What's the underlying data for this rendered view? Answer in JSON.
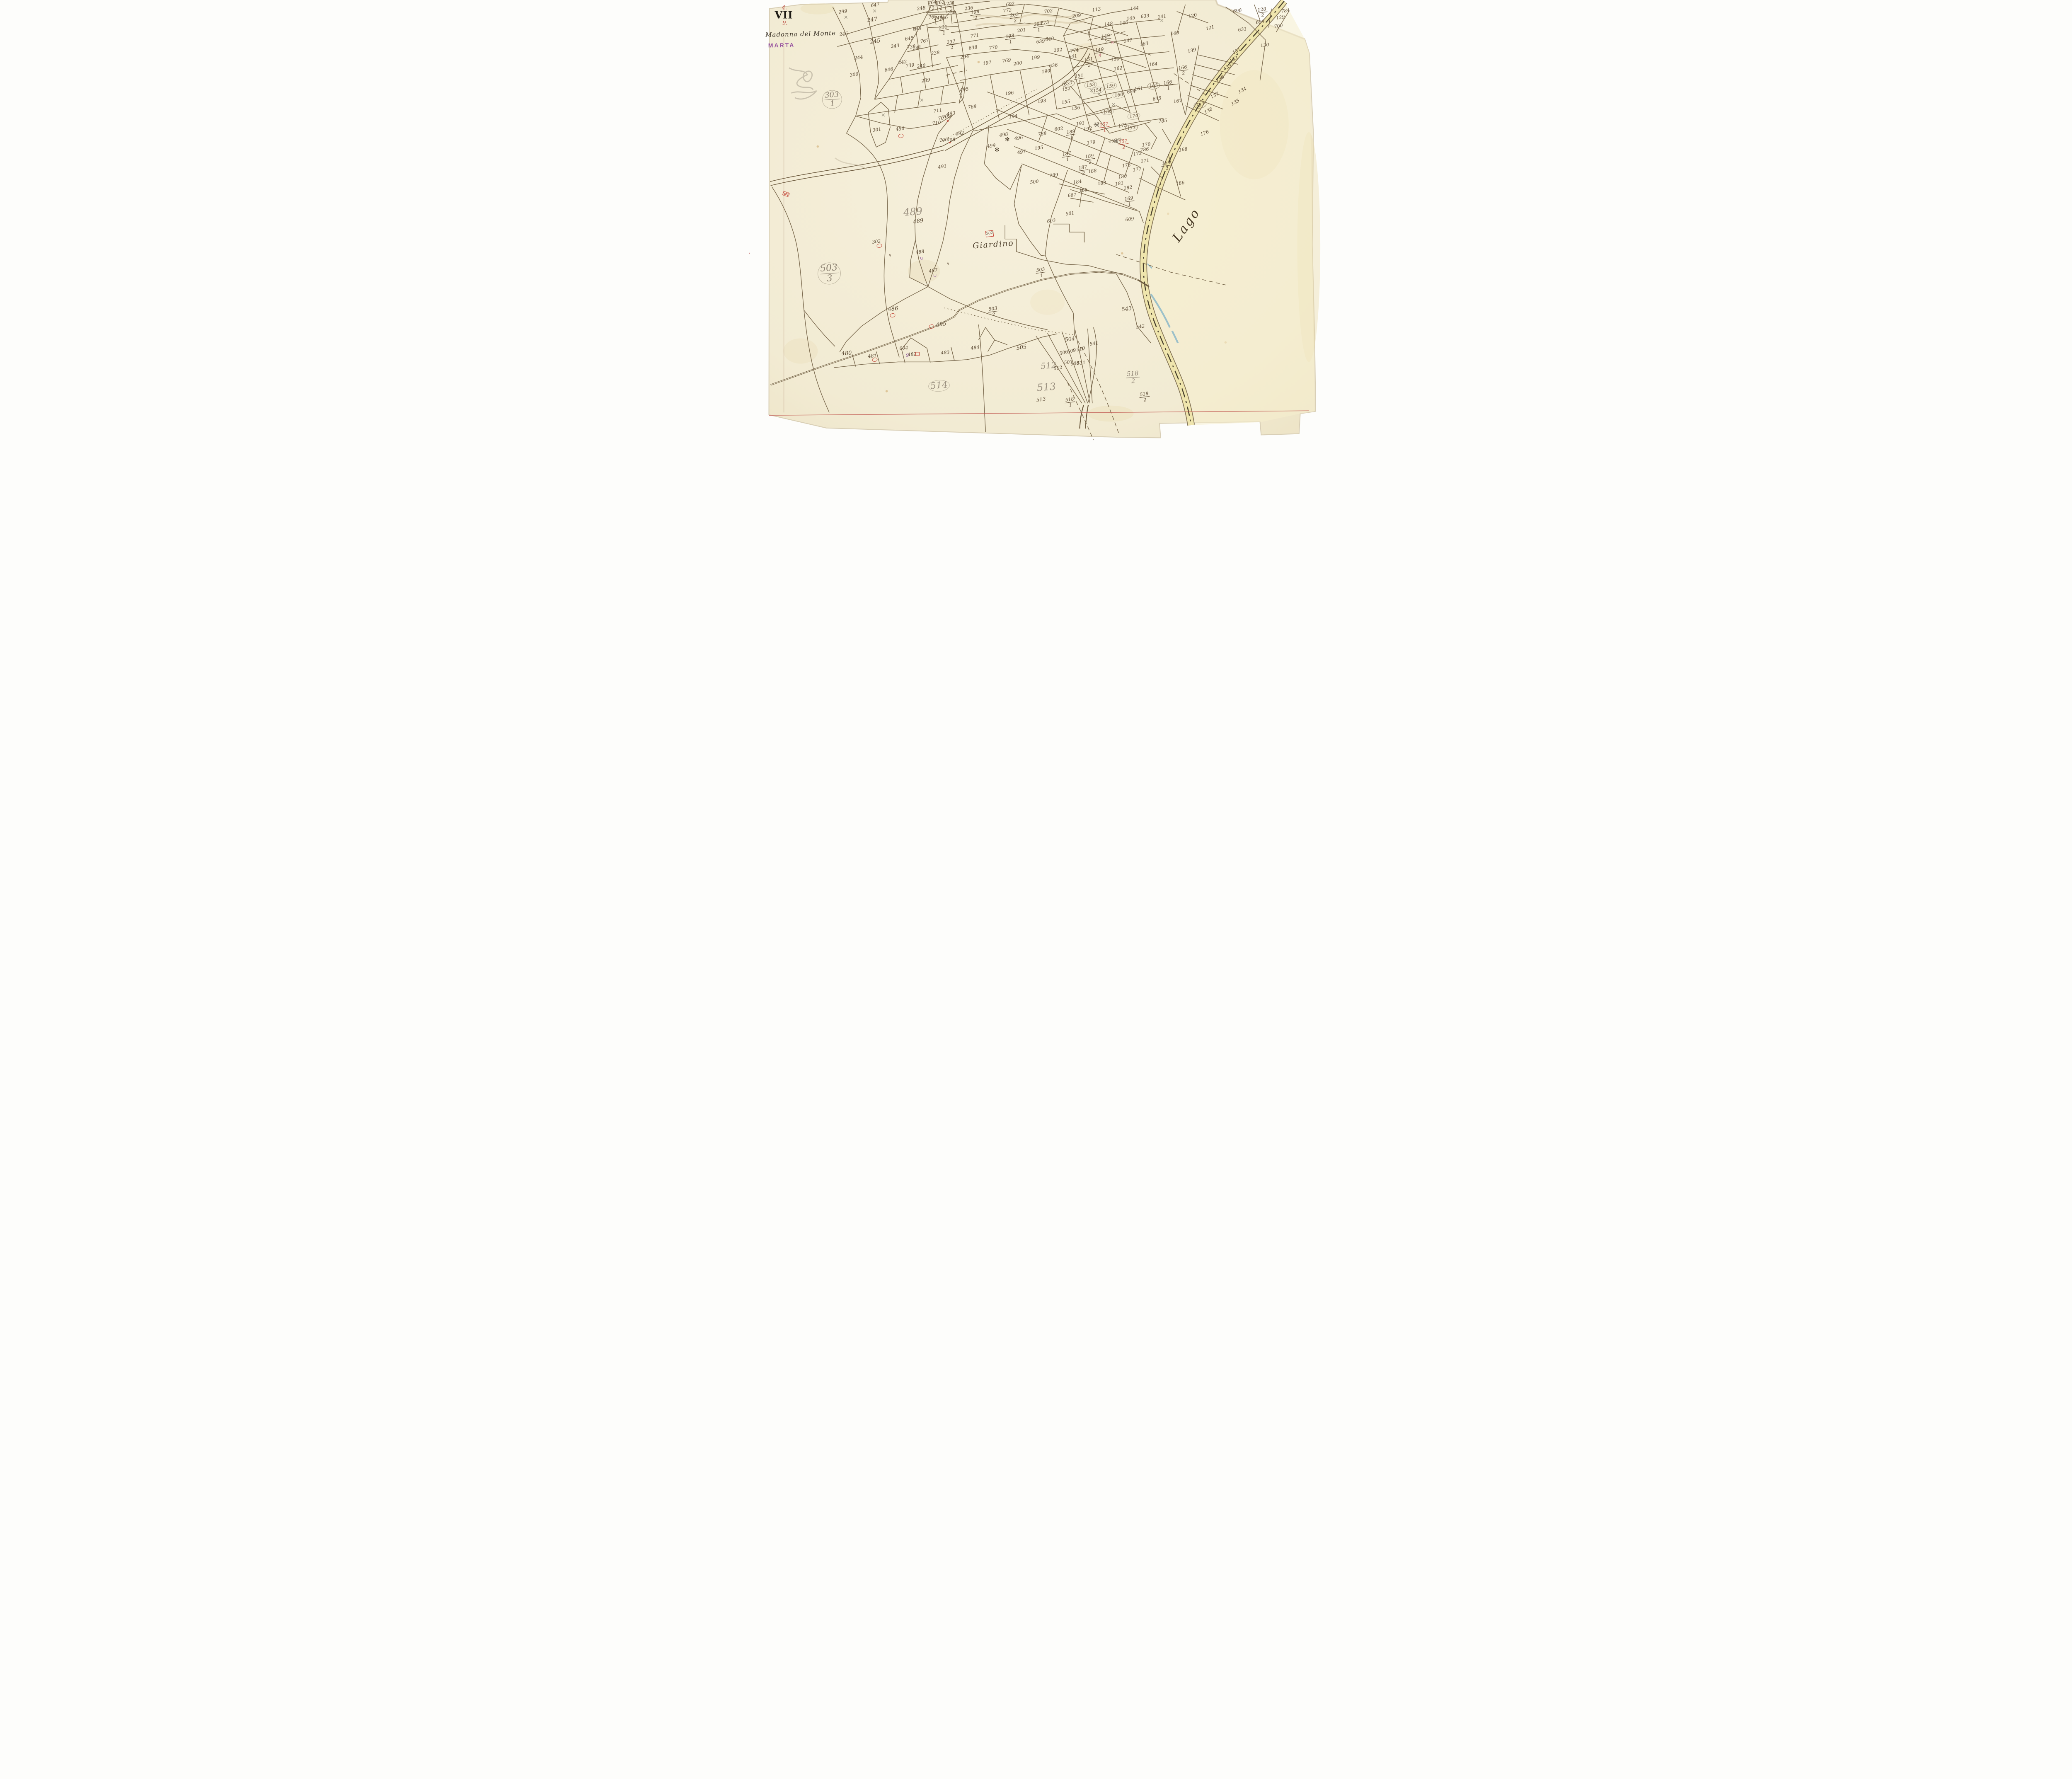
{
  "margin": {
    "plate_top": "4.",
    "plate_roman": "VII",
    "plate_bottom": "9.",
    "title_script": "Madonna del Monte",
    "stamp": "MARTA"
  },
  "map": {
    "place_label": "Giardino",
    "lake_label": "Lago",
    "building_label": "502"
  },
  "colors": {
    "paper": "#f2ebd3",
    "ink_lines": "#6f5d41",
    "ink_text": "#54422c",
    "pencil": "#8e8373",
    "red": "#b03a2e",
    "purple": "#7b3f8e",
    "road_fill": "#efe5ad",
    "stream": "#86b6c8",
    "neatline_red": "#c0544d"
  },
  "parcel_labels": [
    {
      "t": "248",
      "x": 30.0,
      "y": 1.9,
      "s": "i"
    },
    {
      "t": "647",
      "x": 22.0,
      "y": 1.1,
      "s": "i"
    },
    {
      "t": "299",
      "x": 16.4,
      "y": 2.6,
      "s": "i"
    },
    {
      "t": "247",
      "x": 21.5,
      "y": 4.5,
      "s": "i",
      "z": 13
    },
    {
      "t": "246",
      "x": 16.5,
      "y": 7.6,
      "s": "i"
    },
    {
      "t": "245",
      "x": 22.0,
      "y": 9.3,
      "s": "i",
      "z": 13
    },
    {
      "t": "244",
      "x": 19.1,
      "y": 13.0,
      "s": "i"
    },
    {
      "t": "243",
      "x": 25.5,
      "y": 10.3,
      "s": "i"
    },
    {
      "t": "242",
      "x": 26.8,
      "y": 14.0,
      "s": "i"
    },
    {
      "t": "739",
      "x": 28.1,
      "y": 14.7,
      "s": "i"
    },
    {
      "t": "240",
      "x": 30.0,
      "y": 14.8,
      "s": "i"
    },
    {
      "t": "241",
      "x": 29.3,
      "y": 10.7,
      "s": "i"
    },
    {
      "t": "738",
      "x": 28.3,
      "y": 10.5,
      "s": "i"
    },
    {
      "t": "645",
      "x": 27.9,
      "y": 8.7,
      "s": "i"
    },
    {
      "t": "644",
      "x": 29.3,
      "y": 6.4,
      "s": "i"
    },
    {
      "t": "767",
      "x": 30.6,
      "y": 9.2,
      "s": "i"
    },
    {
      "t": "765",
      "x": 32.0,
      "y": 3.8,
      "s": "i"
    },
    {
      "t": "249",
      "x": 33.0,
      "y": 4.0,
      "s": "i"
    },
    {
      "t": "766",
      "x": 33.9,
      "y": 4.0,
      "s": "i"
    },
    {
      "t": "764/2",
      "x": 32.0,
      "y": 1.2,
      "s": "if"
    },
    {
      "t": "763/2",
      "x": 33.4,
      "y": 1.2,
      "s": "if"
    },
    {
      "t": "231/1",
      "x": 33.9,
      "y": 6.8,
      "s": "if"
    },
    {
      "t": "238",
      "x": 32.5,
      "y": 11.9,
      "s": "i"
    },
    {
      "t": "239",
      "x": 30.8,
      "y": 18.1,
      "s": "i"
    },
    {
      "t": "646",
      "x": 24.4,
      "y": 15.7,
      "s": "i"
    },
    {
      "t": "300",
      "x": 18.3,
      "y": 16.8,
      "s": "i"
    },
    {
      "t": "231/2",
      "x": 35.2,
      "y": 1.4,
      "s": "if"
    },
    {
      "t": "250",
      "x": 35.3,
      "y": 2.9,
      "s": "i"
    },
    {
      "t": "236",
      "x": 38.3,
      "y": 1.9,
      "s": "i"
    },
    {
      "t": "198/2",
      "x": 39.5,
      "y": 3.4,
      "s": "if"
    },
    {
      "t": "692",
      "x": 45.5,
      "y": 0.9,
      "s": "i"
    },
    {
      "t": "772",
      "x": 45.0,
      "y": 2.3,
      "s": "i"
    },
    {
      "t": "203/2",
      "x": 46.3,
      "y": 4.0,
      "s": "if"
    },
    {
      "t": "702",
      "x": 52.2,
      "y": 2.5,
      "s": "i"
    },
    {
      "t": "773",
      "x": 51.5,
      "y": 5.1,
      "s": "i"
    },
    {
      "t": "203/1",
      "x": 50.4,
      "y": 6.1,
      "s": "if"
    },
    {
      "t": "201",
      "x": 47.5,
      "y": 6.8,
      "s": "i"
    },
    {
      "t": "771",
      "x": 39.3,
      "y": 8.0,
      "s": "i"
    },
    {
      "t": "198/1",
      "x": 45.5,
      "y": 8.8,
      "s": "if"
    },
    {
      "t": "640",
      "x": 52.4,
      "y": 8.8,
      "s": "i"
    },
    {
      "t": "639",
      "x": 50.8,
      "y": 9.3,
      "s": "i"
    },
    {
      "t": "237/2",
      "x": 35.3,
      "y": 10.1,
      "s": "if"
    },
    {
      "t": "638",
      "x": 39.0,
      "y": 10.7,
      "s": "i"
    },
    {
      "t": "770",
      "x": 42.6,
      "y": 10.7,
      "s": "i"
    },
    {
      "t": "294",
      "x": 37.6,
      "y": 12.8,
      "s": "i"
    },
    {
      "t": "197",
      "x": 41.5,
      "y": 14.2,
      "s": "i"
    },
    {
      "t": "769",
      "x": 44.9,
      "y": 13.6,
      "s": "i"
    },
    {
      "t": "200",
      "x": 46.8,
      "y": 14.3,
      "s": "i"
    },
    {
      "t": "199",
      "x": 49.9,
      "y": 13.0,
      "s": "i"
    },
    {
      "t": "202",
      "x": 53.8,
      "y": 11.3,
      "s": "i"
    },
    {
      "t": "636",
      "x": 53.0,
      "y": 14.7,
      "s": "i"
    },
    {
      "t": "190",
      "x": 51.7,
      "y": 16.0,
      "s": "i"
    },
    {
      "t": "113",
      "x": 60.5,
      "y": 2.1,
      "s": "i"
    },
    {
      "t": "209",
      "x": 57.1,
      "y": 3.5,
      "s": "i"
    },
    {
      "t": "144",
      "x": 67.2,
      "y": 1.9,
      "s": "i"
    },
    {
      "t": "633",
      "x": 69.0,
      "y": 3.6,
      "s": "i"
    },
    {
      "t": "141",
      "x": 71.9,
      "y": 3.7,
      "s": "i"
    },
    {
      "t": "145",
      "x": 66.5,
      "y": 4.1,
      "s": "i"
    },
    {
      "t": "146",
      "x": 65.3,
      "y": 5.1,
      "s": "i"
    },
    {
      "t": "148",
      "x": 62.6,
      "y": 5.4,
      "s": "i"
    },
    {
      "t": "140",
      "x": 74.2,
      "y": 7.5,
      "s": "i"
    },
    {
      "t": "149/2",
      "x": 62.2,
      "y": 8.8,
      "s": "if"
    },
    {
      "t": "147",
      "x": 66.0,
      "y": 9.1,
      "s": "i"
    },
    {
      "t": "163",
      "x": 68.8,
      "y": 9.9,
      "s": "i"
    },
    {
      "t": "774",
      "x": 56.7,
      "y": 11.4,
      "s": "i"
    },
    {
      "t": "641",
      "x": 56.4,
      "y": 12.7,
      "s": "i"
    },
    {
      "t": "149/1",
      "x": 61.1,
      "y": 11.8,
      "s": "if"
    },
    {
      "t": "150",
      "x": 63.8,
      "y": 13.3,
      "s": "i"
    },
    {
      "t": "151/2",
      "x": 59.2,
      "y": 14.0,
      "s": "if"
    },
    {
      "t": "162",
      "x": 64.3,
      "y": 15.4,
      "s": "i"
    },
    {
      "t": "164",
      "x": 70.4,
      "y": 14.4,
      "s": "i"
    },
    {
      "t": "166/2",
      "x": 75.6,
      "y": 15.8,
      "s": "if"
    },
    {
      "t": "151/1",
      "x": 57.6,
      "y": 17.7,
      "s": "if"
    },
    {
      "t": "153",
      "x": 59.5,
      "y": 19.1,
      "s": "i",
      "c": "pc"
    },
    {
      "t": "159",
      "x": 63.0,
      "y": 19.4,
      "s": "i",
      "c": "pc"
    },
    {
      "t": "165",
      "x": 70.5,
      "y": 19.3,
      "s": "i",
      "c": "ic"
    },
    {
      "t": "166/1",
      "x": 73.0,
      "y": 19.2,
      "s": "if"
    },
    {
      "t": "152",
      "x": 55.3,
      "y": 20.0,
      "s": "i"
    },
    {
      "t": "154",
      "x": 60.7,
      "y": 20.3,
      "s": "i",
      "c": "pc"
    },
    {
      "t": "161",
      "x": 67.9,
      "y": 19.9,
      "s": "i"
    },
    {
      "t": "634",
      "x": 66.6,
      "y": 20.6,
      "s": "i"
    },
    {
      "t": "160",
      "x": 64.4,
      "y": 21.3,
      "s": "i",
      "c": "pc"
    },
    {
      "t": "635",
      "x": 71.1,
      "y": 22.2,
      "s": "i"
    },
    {
      "t": "155",
      "x": 55.2,
      "y": 22.9,
      "s": "i"
    },
    {
      "t": "156",
      "x": 56.9,
      "y": 24.3,
      "s": "i"
    },
    {
      "t": "158",
      "x": 62.5,
      "y": 25.1,
      "s": "i",
      "c": "pc"
    },
    {
      "t": "174",
      "x": 67.0,
      "y": 26.1,
      "s": "i",
      "c": "pc"
    },
    {
      "t": "785",
      "x": 72.1,
      "y": 27.2,
      "s": "i"
    },
    {
      "t": "698",
      "x": 85.1,
      "y": 2.4,
      "s": "i"
    },
    {
      "t": "128/2",
      "x": 89.4,
      "y": 2.8,
      "s": "if"
    },
    {
      "t": "784",
      "x": 93.4,
      "y": 2.4,
      "s": "i"
    },
    {
      "t": "129",
      "x": 92.6,
      "y": 3.9,
      "s": "i"
    },
    {
      "t": "699",
      "x": 89.0,
      "y": 4.9,
      "s": "i"
    },
    {
      "t": "700",
      "x": 92.2,
      "y": 5.9,
      "s": "i"
    },
    {
      "t": "631",
      "x": 85.9,
      "y": 6.6,
      "s": "i"
    },
    {
      "t": "121",
      "x": 80.3,
      "y": 6.2,
      "s": "i",
      "r": -15
    },
    {
      "t": "120",
      "x": 77.3,
      "y": 3.5,
      "s": "i",
      "r": -15
    },
    {
      "t": "130",
      "x": 89.8,
      "y": 10.2,
      "s": "i"
    },
    {
      "t": "139",
      "x": 77.1,
      "y": 11.4,
      "s": "i",
      "r": -15
    },
    {
      "t": "131",
      "x": 84.9,
      "y": 11.5,
      "s": "i",
      "r": -30
    },
    {
      "t": "132",
      "x": 84.4,
      "y": 13.3,
      "s": "i",
      "r": -30
    },
    {
      "t": "133",
      "x": 83.3,
      "y": 15.1,
      "s": "i",
      "r": -30
    },
    {
      "t": "136",
      "x": 82.0,
      "y": 17.7,
      "s": "i",
      "r": -30
    },
    {
      "t": "134",
      "x": 85.9,
      "y": 20.3,
      "s": "i",
      "r": -30
    },
    {
      "t": "137",
      "x": 81.1,
      "y": 21.4,
      "s": "i",
      "r": -30
    },
    {
      "t": "135",
      "x": 84.7,
      "y": 23.0,
      "s": "i",
      "r": -30
    },
    {
      "t": "138",
      "x": 80.0,
      "y": 24.9,
      "s": "i",
      "r": -30
    },
    {
      "t": "176",
      "x": 79.4,
      "y": 29.9,
      "s": "i",
      "r": -20
    },
    {
      "t": "167",
      "x": 74.7,
      "y": 22.7,
      "s": "i"
    },
    {
      "t": "787",
      "x": 78.6,
      "y": 23.6,
      "s": "i",
      "c": "ic"
    },
    {
      "t": "495",
      "x": 37.5,
      "y": 20.1,
      "s": "i"
    },
    {
      "t": "768",
      "x": 38.9,
      "y": 24.0,
      "s": "i"
    },
    {
      "t": "196",
      "x": 45.4,
      "y": 21.0,
      "s": "i"
    },
    {
      "t": "193",
      "x": 51.0,
      "y": 22.7,
      "s": "i"
    },
    {
      "t": "637",
      "x": 55.6,
      "y": 18.8,
      "s": "i",
      "c": "ic"
    },
    {
      "t": "191",
      "x": 57.7,
      "y": 27.8,
      "s": "i"
    },
    {
      "t": "192",
      "x": 59.0,
      "y": 29.0,
      "s": "i"
    },
    {
      "t": "189/1",
      "x": 56.1,
      "y": 30.3,
      "s": "if"
    },
    {
      "t": "175",
      "x": 65.1,
      "y": 28.2,
      "s": "i"
    },
    {
      "t": "173",
      "x": 66.6,
      "y": 28.8,
      "s": "i",
      "c": "ic"
    },
    {
      "t": "179",
      "x": 59.6,
      "y": 32.1,
      "s": "i"
    },
    {
      "t": "157/1",
      "x": 61.9,
      "y": 28.6,
      "s": "rf"
    },
    {
      "t": "79",
      "x": 60.5,
      "y": 28.0,
      "s": "x"
    },
    {
      "t": "159/2",
      "x": 63.8,
      "y": 31.6,
      "s": "x"
    },
    {
      "t": "157/2",
      "x": 65.2,
      "y": 32.4,
      "s": "rf"
    },
    {
      "t": "170",
      "x": 69.2,
      "y": 32.5,
      "s": "i"
    },
    {
      "t": "786",
      "x": 68.9,
      "y": 33.6,
      "s": "i"
    },
    {
      "t": "172",
      "x": 67.7,
      "y": 34.6,
      "s": "i"
    },
    {
      "t": "168",
      "x": 75.6,
      "y": 33.6,
      "s": "i"
    },
    {
      "t": "187/1",
      "x": 55.4,
      "y": 35.2,
      "s": "if"
    },
    {
      "t": "189/2",
      "x": 59.4,
      "y": 35.8,
      "s": "if"
    },
    {
      "t": "171",
      "x": 69.0,
      "y": 36.2,
      "s": "i"
    },
    {
      "t": "178",
      "x": 65.7,
      "y": 37.2,
      "s": "i"
    },
    {
      "t": "187/2",
      "x": 58.2,
      "y": 38.3,
      "s": "if"
    },
    {
      "t": "188",
      "x": 59.8,
      "y": 38.5,
      "s": "i"
    },
    {
      "t": "177",
      "x": 67.6,
      "y": 38.1,
      "s": "i"
    },
    {
      "t": "169/2",
      "x": 72.7,
      "y": 37.3,
      "s": "if"
    },
    {
      "t": "180",
      "x": 65.1,
      "y": 39.7,
      "s": "i"
    },
    {
      "t": "183",
      "x": 61.5,
      "y": 41.2,
      "s": "i"
    },
    {
      "t": "184",
      "x": 57.2,
      "y": 40.9,
      "s": "i"
    },
    {
      "t": "185",
      "x": 58.2,
      "y": 42.8,
      "s": "i"
    },
    {
      "t": "181",
      "x": 64.5,
      "y": 41.3,
      "s": "i"
    },
    {
      "t": "182",
      "x": 66.0,
      "y": 42.2,
      "s": "i"
    },
    {
      "t": "186",
      "x": 75.1,
      "y": 41.2,
      "s": "i"
    },
    {
      "t": "169/1",
      "x": 66.2,
      "y": 45.3,
      "s": "if"
    },
    {
      "t": "493",
      "x": 35.2,
      "y": 25.5,
      "s": "i"
    },
    {
      "t": "709",
      "x": 34.4,
      "y": 26.2,
      "s": "i"
    },
    {
      "t": "707",
      "x": 33.7,
      "y": 26.6,
      "s": "i"
    },
    {
      "t": "194",
      "x": 46.0,
      "y": 26.2,
      "s": "i"
    },
    {
      "t": "492",
      "x": 36.7,
      "y": 30.0,
      "s": "i"
    },
    {
      "t": "706",
      "x": 33.9,
      "y": 31.5,
      "s": "i"
    },
    {
      "t": "708",
      "x": 35.2,
      "y": 31.5,
      "s": "i"
    },
    {
      "t": "711",
      "x": 32.9,
      "y": 24.9,
      "s": "i"
    },
    {
      "t": "710",
      "x": 32.7,
      "y": 27.7,
      "s": "i"
    },
    {
      "t": "498",
      "x": 44.4,
      "y": 30.3,
      "s": "i"
    },
    {
      "t": "496",
      "x": 47.0,
      "y": 31.0,
      "s": "i"
    },
    {
      "t": "499",
      "x": 42.2,
      "y": 32.8,
      "s": "i"
    },
    {
      "t": "497",
      "x": 47.5,
      "y": 34.2,
      "s": "i"
    },
    {
      "t": "195",
      "x": 50.5,
      "y": 33.3,
      "s": "i"
    },
    {
      "t": "788",
      "x": 51.1,
      "y": 30.1,
      "s": "i"
    },
    {
      "t": "602",
      "x": 54.0,
      "y": 29.0,
      "s": "i"
    },
    {
      "t": "789",
      "x": 53.1,
      "y": 39.4,
      "s": "i"
    },
    {
      "t": "500",
      "x": 49.7,
      "y": 40.9,
      "s": "i"
    },
    {
      "t": "301",
      "x": 22.3,
      "y": 29.2,
      "s": "i"
    },
    {
      "t": "490",
      "x": 26.3,
      "y": 29.0,
      "s": "i"
    },
    {
      "t": "491",
      "x": 33.7,
      "y": 37.5,
      "s": "i"
    },
    {
      "t": "302",
      "x": 22.2,
      "y": 54.3,
      "s": "i"
    },
    {
      "t": "488",
      "x": 29.8,
      "y": 56.7,
      "s": "i"
    },
    {
      "t": "487",
      "x": 32.1,
      "y": 60.9,
      "s": "i"
    },
    {
      "t": "667",
      "x": 56.3,
      "y": 43.9,
      "s": "i"
    },
    {
      "t": "501",
      "x": 55.9,
      "y": 48.0,
      "s": "i"
    },
    {
      "t": "603",
      "x": 52.7,
      "y": 49.7,
      "s": "i"
    },
    {
      "t": "609",
      "x": 66.3,
      "y": 49.3,
      "s": "i"
    },
    {
      "t": "303/1",
      "x": 14.5,
      "y": 22.4,
      "s": "pf",
      "c": "pcb",
      "z": 18
    },
    {
      "t": "503/3",
      "x": 14.0,
      "y": 61.5,
      "s": "pf",
      "c": "pcb",
      "z": 22
    },
    {
      "t": "489",
      "x": 28.6,
      "y": 47.6,
      "s": "pb"
    },
    {
      "t": "489",
      "x": 29.5,
      "y": 49.8,
      "s": "i",
      "z": 13
    },
    {
      "t": "503/1",
      "x": 50.9,
      "y": 61.3,
      "s": "if"
    },
    {
      "t": "503/2",
      "x": 42.6,
      "y": 70.1,
      "s": "if"
    },
    {
      "t": "485",
      "x": 33.5,
      "y": 73.0,
      "s": "i",
      "z": 13
    },
    {
      "t": "486",
      "x": 25.1,
      "y": 69.5,
      "s": "i",
      "z": 13
    },
    {
      "t": "480",
      "x": 17.0,
      "y": 79.5,
      "s": "i",
      "z": 13,
      "r": -4
    },
    {
      "t": "481",
      "x": 21.5,
      "y": 80.1,
      "s": "i",
      "r": -4
    },
    {
      "t": "604",
      "x": 27.0,
      "y": 78.3,
      "s": "i",
      "r": -4
    },
    {
      "t": "9",
      "x": 27.6,
      "y": 79.9,
      "s": "pp"
    },
    {
      "t": "482",
      "x": 28.4,
      "y": 79.7,
      "s": "i",
      "r": -4
    },
    {
      "t": "483",
      "x": 34.2,
      "y": 79.3,
      "s": "i",
      "r": -4
    },
    {
      "t": "484",
      "x": 39.4,
      "y": 78.2,
      "s": "i"
    },
    {
      "t": "505",
      "x": 47.5,
      "y": 78.2,
      "s": "i",
      "z": 13
    },
    {
      "t": "543",
      "x": 65.8,
      "y": 69.5,
      "s": "i",
      "z": 13
    },
    {
      "t": "542",
      "x": 68.2,
      "y": 73.4,
      "s": "i"
    },
    {
      "t": "504",
      "x": 55.9,
      "y": 76.3,
      "s": "i",
      "z": 13
    },
    {
      "t": "541",
      "x": 60.1,
      "y": 77.3,
      "s": "i"
    },
    {
      "t": "506",
      "x": 54.8,
      "y": 79.3,
      "s": "i",
      "r": -14
    },
    {
      "t": "509",
      "x": 56.2,
      "y": 78.9,
      "s": "i",
      "r": -14
    },
    {
      "t": "510",
      "x": 57.8,
      "y": 78.5,
      "s": "i",
      "r": -14
    },
    {
      "t": "507",
      "x": 55.6,
      "y": 81.5,
      "s": "i",
      "r": -8
    },
    {
      "t": "508",
      "x": 56.8,
      "y": 81.7,
      "s": "i",
      "r": -8
    },
    {
      "t": "511",
      "x": 57.9,
      "y": 81.6,
      "s": "i",
      "r": -8
    },
    {
      "t": "512",
      "x": 52.2,
      "y": 82.2,
      "s": "pb",
      "z": 20
    },
    {
      "t": "512",
      "x": 53.8,
      "y": 82.8,
      "s": "i"
    },
    {
      "t": "514",
      "x": 33.1,
      "y": 86.8,
      "s": "pb",
      "c": "pcb",
      "z": 22
    },
    {
      "t": "513",
      "x": 51.8,
      "y": 87.0,
      "s": "pb"
    },
    {
      "t": "513",
      "x": 50.9,
      "y": 89.8,
      "s": "i",
      "z": 12
    },
    {
      "t": "518/1",
      "x": 55.9,
      "y": 90.5,
      "s": "if"
    },
    {
      "t": "518/2",
      "x": 66.9,
      "y": 84.9,
      "s": "pf",
      "z": 15
    },
    {
      "t": "518/2",
      "x": 68.9,
      "y": 89.3,
      "s": "if"
    }
  ],
  "marks": [
    {
      "k": "ro",
      "x": 26.5,
      "y": 30.6
    },
    {
      "k": "ro",
      "x": 22.7,
      "y": 55.3
    },
    {
      "k": "ro",
      "x": 25.0,
      "y": 70.9
    },
    {
      "k": "ro",
      "x": 21.9,
      "y": 80.9
    },
    {
      "k": "ro",
      "x": 31.8,
      "y": 73.4
    },
    {
      "k": "rs",
      "x": 29.4,
      "y": 79.6
    },
    {
      "k": "rb",
      "x": 41.9,
      "y": 52.6
    },
    {
      "k": "rd",
      "x": 34.6,
      "y": 27.2
    },
    {
      "k": "rd",
      "x": 35.0,
      "y": 32.1
    },
    {
      "k": "pu",
      "x": 30.1,
      "y": 58.2
    },
    {
      "k": "pu",
      "x": 32.4,
      "y": 62.1
    },
    {
      "k": "rh",
      "x": 6.5,
      "y": 43.6
    },
    {
      "k": "px",
      "x": 16.9,
      "y": 3.9
    },
    {
      "k": "px",
      "x": 21.9,
      "y": 2.5
    },
    {
      "k": "px",
      "x": 71.9,
      "y": 4.7
    },
    {
      "k": "px",
      "x": 59.7,
      "y": 20.4
    },
    {
      "k": "px",
      "x": 61.0,
      "y": 21.2
    },
    {
      "k": "px",
      "x": 63.5,
      "y": 23.6
    },
    {
      "k": "px",
      "x": 57.7,
      "y": 21.9
    },
    {
      "k": "px",
      "x": 36.9,
      "y": 21.1
    },
    {
      "k": "px",
      "x": 30.1,
      "y": 22.6
    },
    {
      "k": "px",
      "x": 23.4,
      "y": 25.9
    },
    {
      "k": "kx",
      "x": 63.3,
      "y": 9.5
    },
    {
      "k": "kx",
      "x": 61.1,
      "y": 12.4
    },
    {
      "k": "ast",
      "x": 45.0,
      "y": 31.4
    },
    {
      "k": "ast",
      "x": 43.2,
      "y": 33.7
    },
    {
      "k": "ck",
      "x": 24.6,
      "y": 57.5
    },
    {
      "k": "ck",
      "x": 34.7,
      "y": 59.4
    },
    {
      "k": "bx",
      "x": 60.6,
      "y": 28.2
    },
    {
      "k": "bx",
      "x": 63.9,
      "y": 31.8
    }
  ]
}
